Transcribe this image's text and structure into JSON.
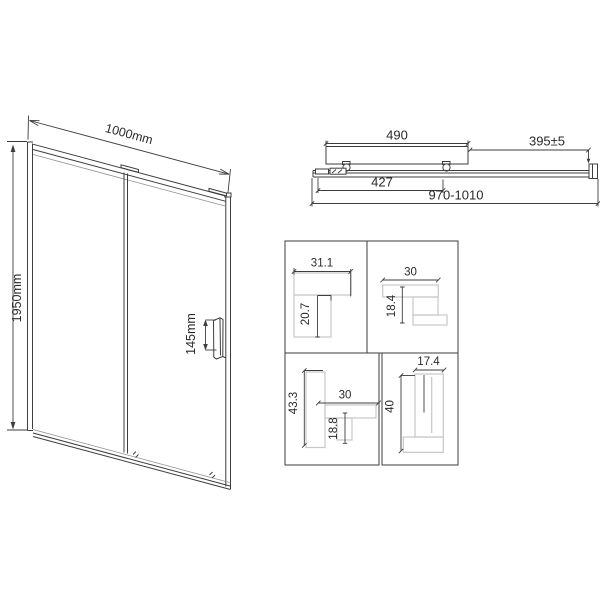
{
  "drawing_title": "sliding shower door technical drawing",
  "front_view": {
    "width_label": "1000mm",
    "height_label": "1950mm",
    "handle_label": "145mm"
  },
  "top_view": {
    "door_panel_width": "490",
    "fixed_panel_width": "395±5",
    "glass_width": "427",
    "overall_adjustment_range": "970-1010"
  },
  "profiles": {
    "p1": {
      "width": "31.1",
      "height": "20.7"
    },
    "p2": {
      "width": "30",
      "height": "18.4"
    },
    "p3": {
      "height": "43.3",
      "width": "30",
      "inner_height": "18.8"
    },
    "p4": {
      "width": "17.4",
      "height": "40"
    }
  },
  "colors": {
    "line": "#3d3d3d",
    "profile_outline": "#c7c7c7",
    "background": "#ffffff"
  }
}
